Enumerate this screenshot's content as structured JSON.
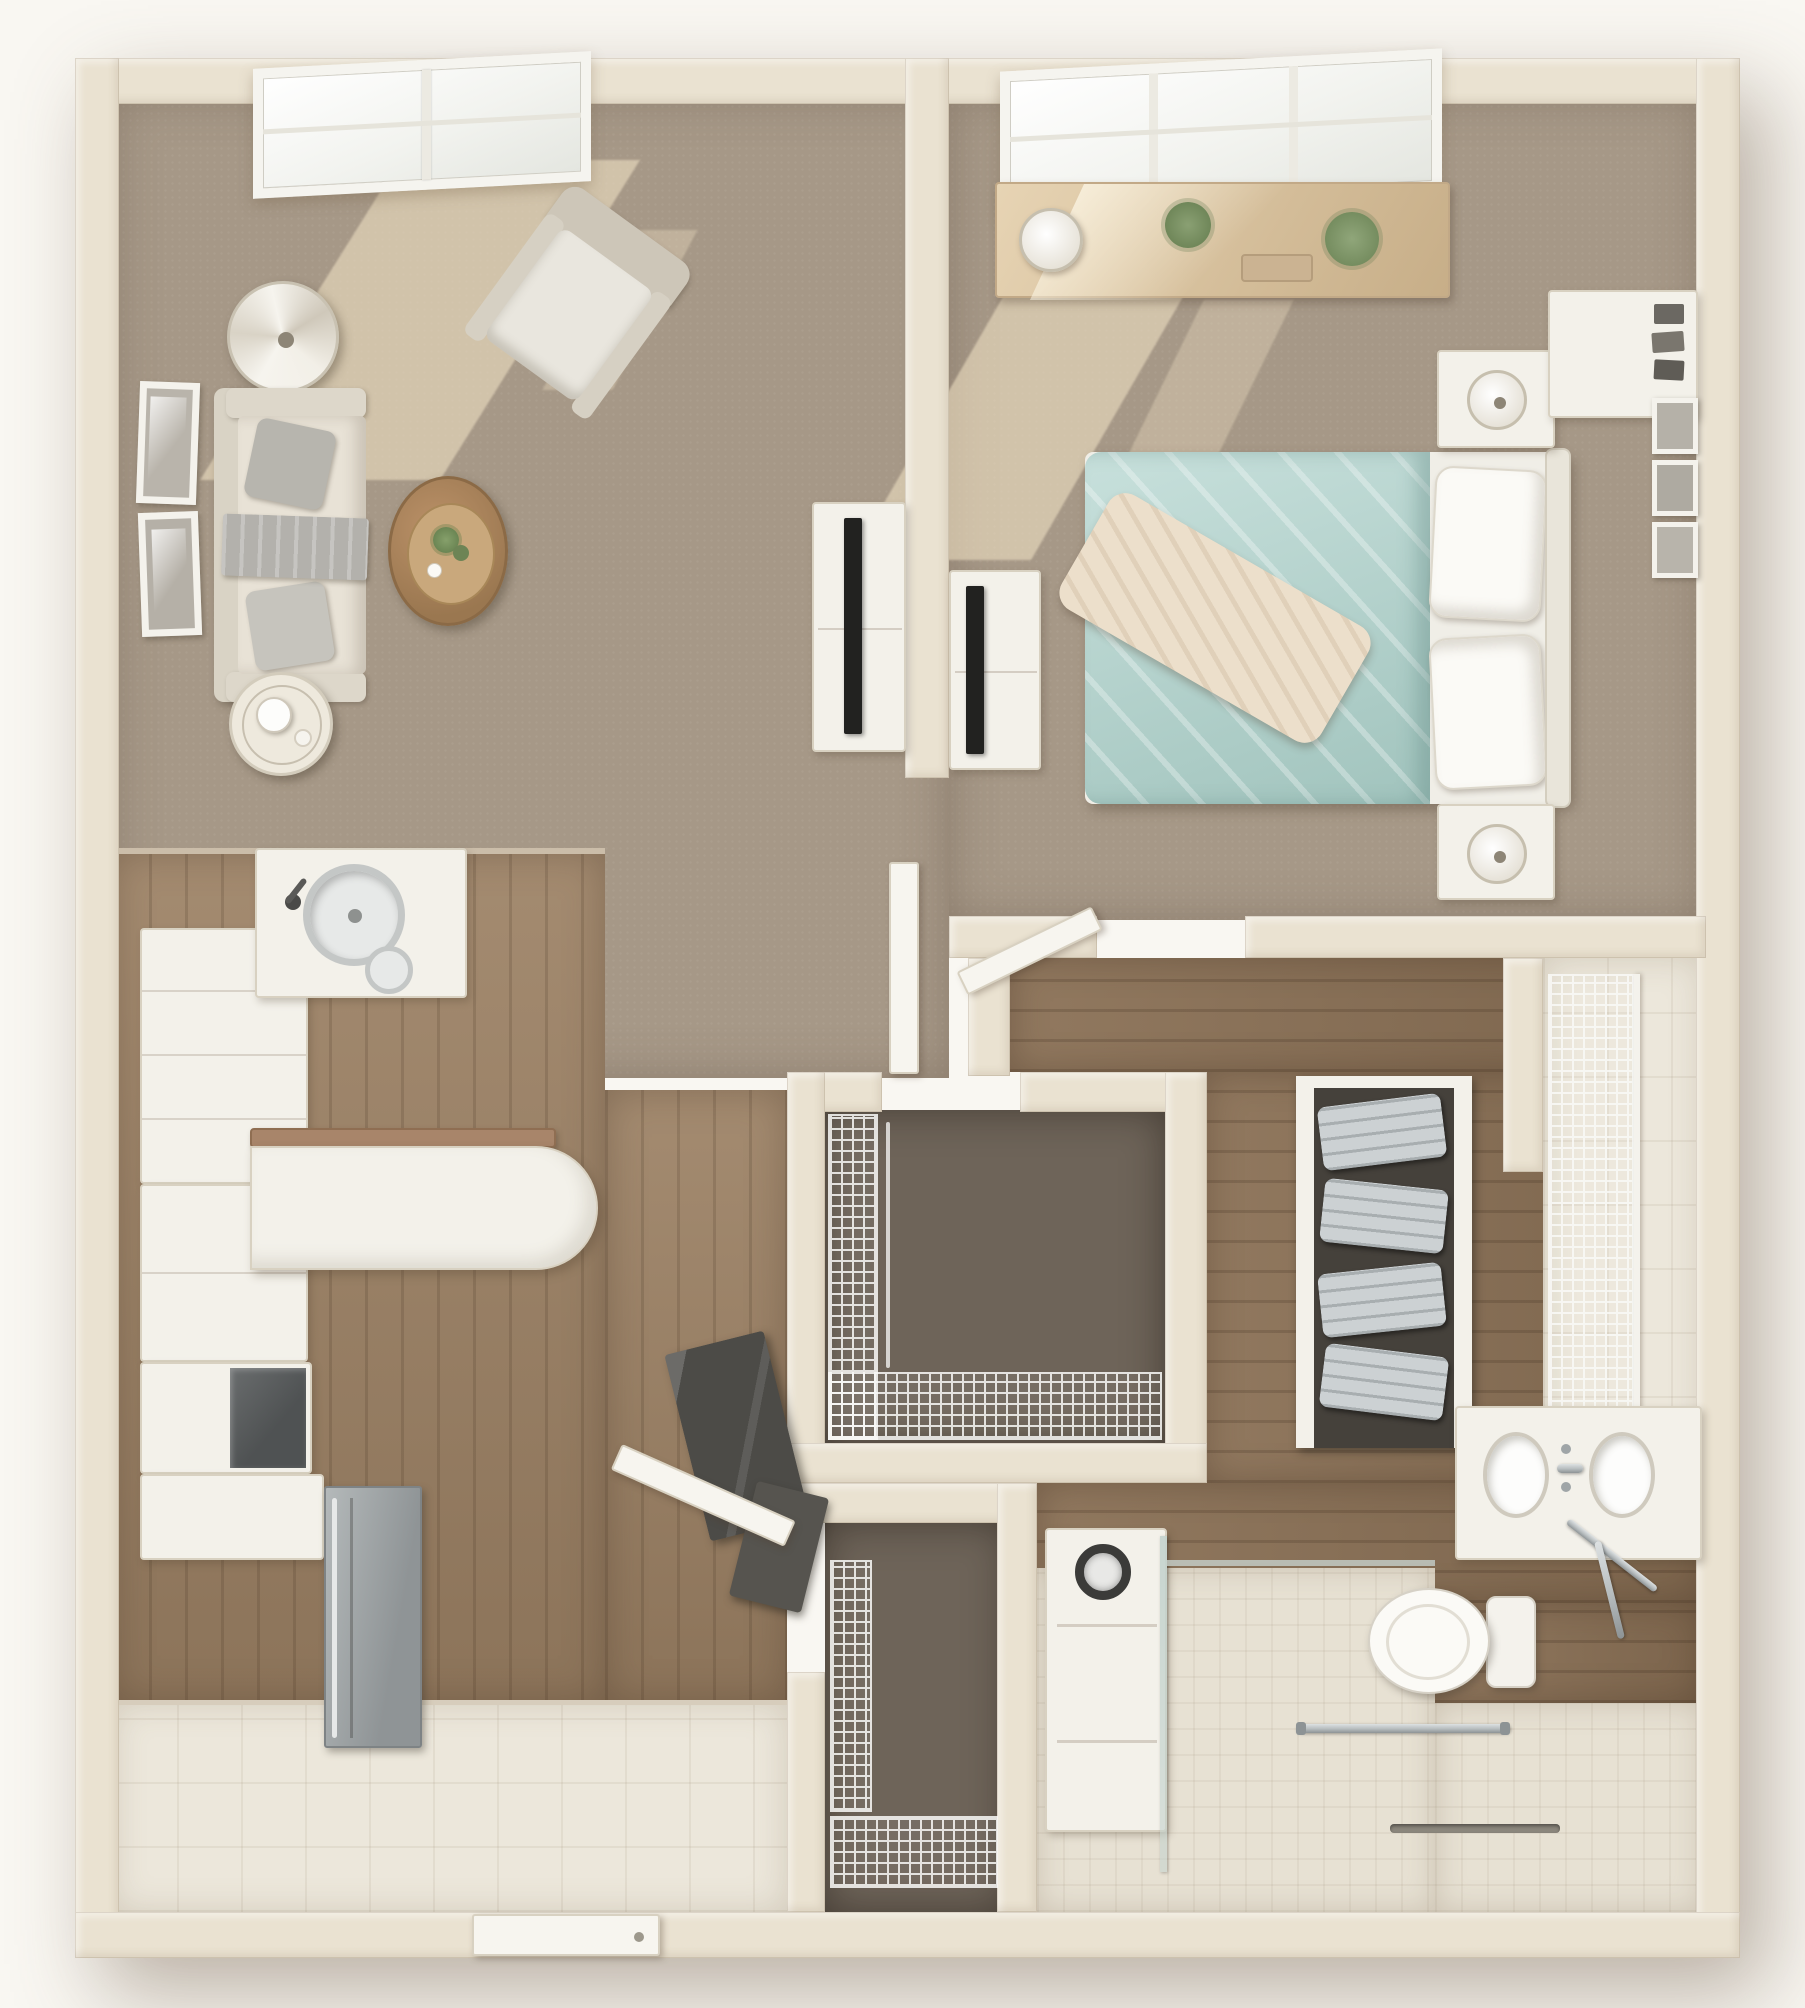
{
  "meta": {
    "kind": "3d-top-down-floor-plan-render",
    "unit_type": "one-bedroom apartment with one bathroom, kitchen, entry, walk-in closet and storage closets",
    "view": "dollhouse overhead view, no text labels visible"
  },
  "palette": {
    "page_bg": "#f9f7f2",
    "wall": "#eae2d1",
    "wall_edge": "#d6cbb6",
    "carpet": "#a69887",
    "sunlight": "rgba(244,229,199,0.55)",
    "wood": "#9c8164",
    "wood_dark": "#8a7055",
    "tile": "#ece7db",
    "shower_tile": "#e7e1d3",
    "closet_floor": "#6e6459",
    "white_furniture": "#f3f1ea",
    "furniture_edge": "#d8d1c1",
    "sofa_fabric": "#e8e2d6",
    "cushion_gray": "#b7b5ae",
    "teal_bedding": "#b5d6d0",
    "teal_deep": "#9cc4bd",
    "throw_cream": "#ecdfcb",
    "tv_black": "#222220",
    "steel": "#a2a7a8",
    "chrome": "#b6bcbe",
    "plant_green": "#7e9068",
    "counter_wood": "#a8856a",
    "dark_panel": "#4c4b47",
    "wire_shelf": "#fafaf8",
    "towel_gray": "#ccd1d3"
  },
  "rooms": [
    {
      "id": "living-room",
      "name": "Living Room",
      "floor": "carpet",
      "furniture": [
        "picture-window",
        "sofa",
        "gray-accent-pillows",
        "gray-throw",
        "armchair",
        "floor-lamp",
        "round-coffee-table",
        "round-side-table",
        "two-wall-art-frames",
        "tv-console",
        "wall-mounted-tv"
      ]
    },
    {
      "id": "bedroom",
      "name": "Bedroom",
      "floor": "carpet",
      "furniture": [
        "picture-window",
        "dresser-with-lamp-and-plants",
        "bed-with-teal-bedding",
        "cream-throw-blanket",
        "white-pillows",
        "headboard",
        "nightstand-with-lamp-top",
        "nightstand-with-lamp-bottom",
        "corner-shelf",
        "three-wall-frames",
        "tv-console",
        "wall-mounted-tv"
      ]
    },
    {
      "id": "kitchen",
      "name": "Kitchen",
      "floor": "wood",
      "furniture": [
        "cabinet-run",
        "glass-front-cabinet",
        "stainless-dishwasher",
        "round-sink",
        "prep-sink",
        "faucet",
        "peninsula-counter",
        "wood-bar-top"
      ]
    },
    {
      "id": "entry",
      "name": "Entry",
      "floor": "tile",
      "furniture": [
        "front-door",
        "dark-hall-tree",
        "open-door-leaf"
      ]
    },
    {
      "id": "walk-in-closet",
      "name": "Walk-in Closet",
      "floor": "dark-carpet",
      "furniture": [
        "wire-shelving-left",
        "wire-shelving-bottom",
        "open-closet-door"
      ]
    },
    {
      "id": "storage-closet",
      "name": "Storage Closet",
      "floor": "dark-carpet",
      "furniture": [
        "wire-shelving"
      ]
    },
    {
      "id": "linen-closet",
      "name": "Linen Closet",
      "floor": "tile",
      "furniture": [
        "wire-shelving"
      ]
    },
    {
      "id": "bathroom",
      "name": "Bathroom",
      "floor": "wood-and-tile",
      "furniture": [
        "double-sink-vanity",
        "chrome-faucets",
        "toilet",
        "stacked-towel-shelf",
        "washer",
        "roll-in-shower",
        "grab-bar",
        "glass-partition",
        "linear-drain",
        "chrome-towel-rack"
      ]
    }
  ]
}
